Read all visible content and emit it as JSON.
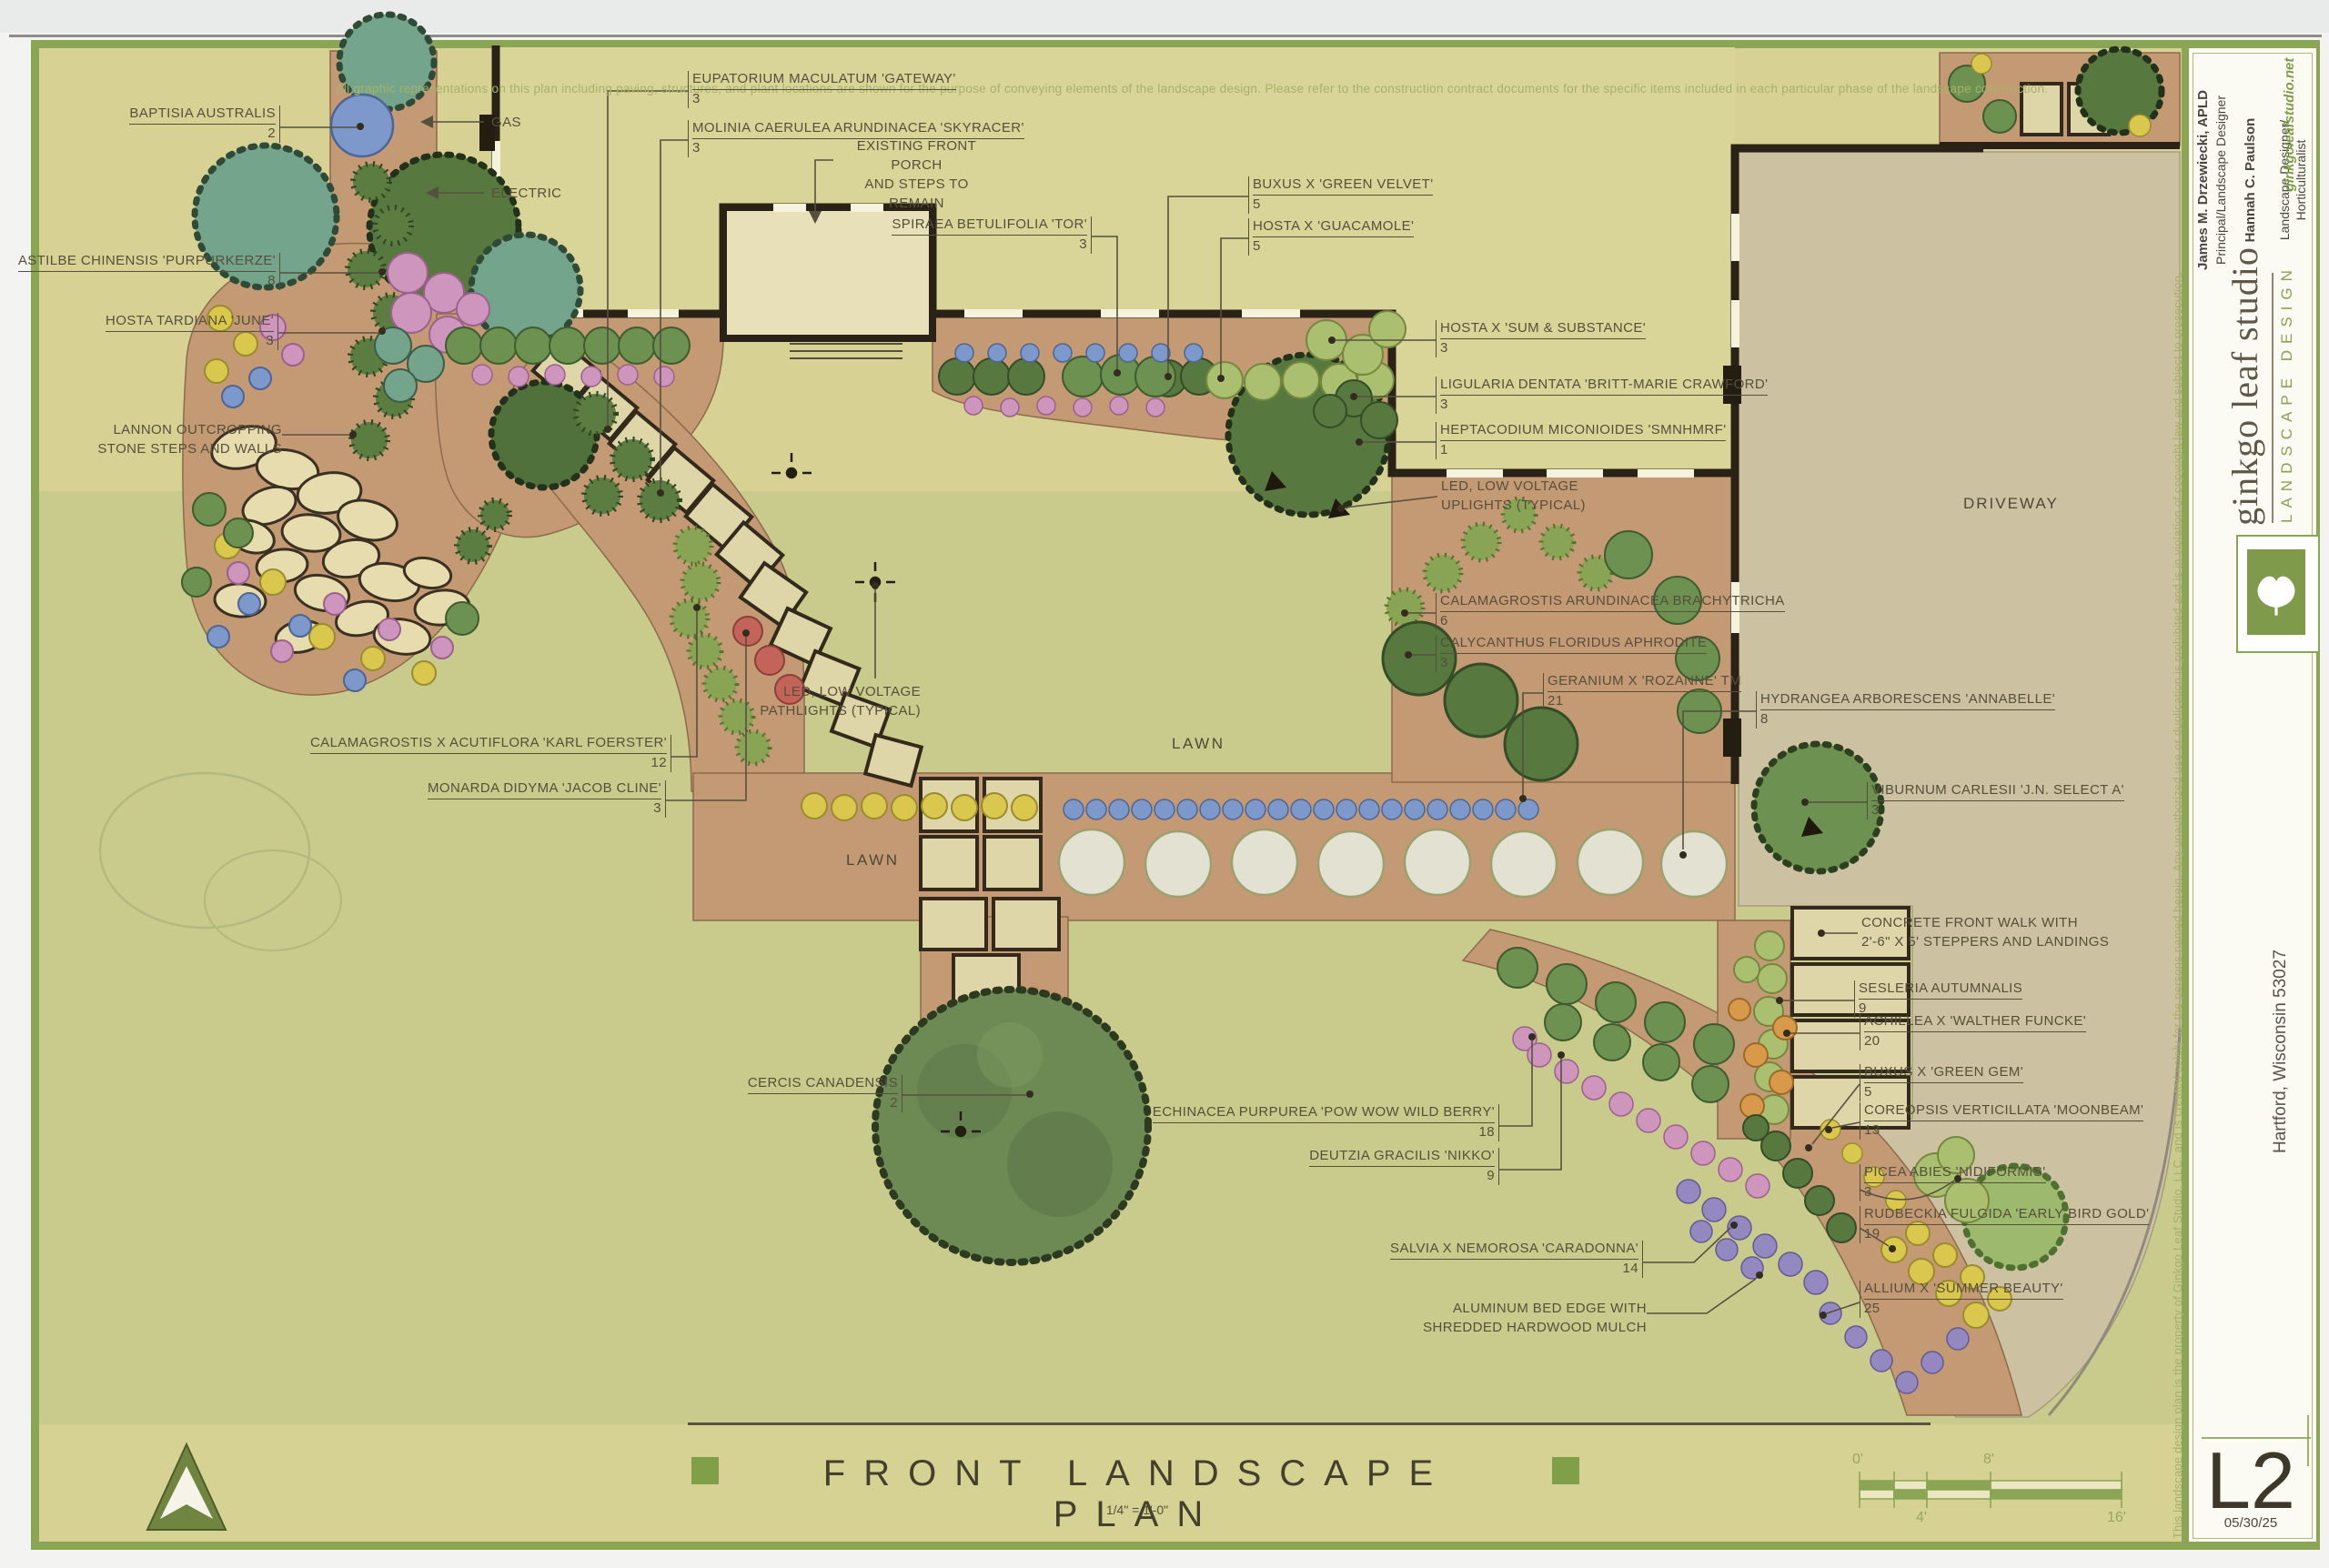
{
  "sheet": {
    "disclaimer": "All graphic representations on this plan including paving, structures, and plant locations are shown for the purpose of conveying elements of the landscape design.  Please refer to the construction contract documents for the specific items included in each particular phase of the landscape construction.",
    "copyright": "This landscape design plan is the property of Ginkgo Leaf Studio, LLC, and is created solely for the persons named herein.  Any unauthorized use or duplication is prohibited and is in violation of copyright law and subject to prosecution.",
    "title": "FRONT LANDSCAPE PLAN",
    "scale_note": "1/4\" = 1'-0\"",
    "north_label": "north"
  },
  "title_block": {
    "studio_name": "ginkgo leaf studio",
    "studio_tagline": "LANDSCAPE DESIGN",
    "credits": [
      {
        "name": "James M. Drzewiecki, APLD",
        "role": "Principal/Landscape Designer"
      },
      {
        "name": "Hannah C. Paulson",
        "role": "Landscape Designer/\nHorticulturalist"
      }
    ],
    "website": "ginkgoleafstudio.net",
    "project_location": "Hartford, Wisconsin 53027",
    "sheet_number": "L2",
    "date": "05/30/25"
  },
  "scale_bar": {
    "d0": "0'",
    "d4": "4'",
    "d8": "8'",
    "d16": "16'"
  },
  "areas": {
    "lawn": "LAWN",
    "driveway": "DRIVEWAY"
  },
  "plants": [
    {
      "label": "BAPTISIA AUSTRALIS",
      "qty": "2"
    },
    {
      "label": "ASTILBE CHINENSIS 'PURPURKERZE'",
      "qty": "8"
    },
    {
      "label": "HOSTA TARDIANA 'JUNE'",
      "qty": "3"
    },
    {
      "label": "CALAMAGROSTIS X ACUTIFLORA 'KARL FOERSTER'",
      "qty": "12"
    },
    {
      "label": "MONARDA DIDYMA 'JACOB CLINE'",
      "qty": "3"
    },
    {
      "label": "CERCIS CANADENSIS",
      "qty": "2"
    },
    {
      "label": "ECHINACEA PURPUREA 'POW WOW WILD BERRY'",
      "qty": "18"
    },
    {
      "label": "DEUTZIA GRACILIS 'NIKKO'",
      "qty": "9"
    },
    {
      "label": "SALVIA X NEMOROSA 'CARADONNA'",
      "qty": "14"
    },
    {
      "label": "SPIRAEA BETULIFOLIA 'TOR'",
      "qty": "3"
    },
    {
      "label": "EUPATORIUM MACULATUM 'GATEWAY'",
      "qty": "3"
    },
    {
      "label": "MOLINIA CAERULEA ARUNDINACEA 'SKYRACER'",
      "qty": "3"
    },
    {
      "label": "BUXUS X 'GREEN VELVET'",
      "qty": "5"
    },
    {
      "label": "HOSTA X 'GUACAMOLE'",
      "qty": "5"
    },
    {
      "label": "HOSTA X 'SUM & SUBSTANCE'",
      "qty": "3"
    },
    {
      "label": "LIGULARIA DENTATA 'BRITT-MARIE CRAWFORD'",
      "qty": "3"
    },
    {
      "label": "HEPTACODIUM MICONIOIDES 'SMNHMRF'",
      "qty": "1"
    },
    {
      "label": "CALAMAGROSTIS ARUNDINACEA BRACHYTRICHA",
      "qty": "6"
    },
    {
      "label": "CALYCANTHUS FLORIDUS APHRODITE",
      "qty": "3"
    },
    {
      "label": "GERANIUM X 'ROZANNE' TM",
      "qty": "21"
    },
    {
      "label": "HYDRANGEA ARBORESCENS 'ANNABELLE'",
      "qty": "8"
    },
    {
      "label": "VIBURNUM CARLESII 'J.N. SELECT A'",
      "qty": "3"
    },
    {
      "label": "SESLERIA AUTUMNALIS",
      "qty": "9"
    },
    {
      "label": "ACHILLEA X 'WALTHER FUNCKE'",
      "qty": "20"
    },
    {
      "label": "BUXUS X 'GREEN GEM'",
      "qty": "5"
    },
    {
      "label": "COREOPSIS VERTICILLATA 'MOONBEAM'",
      "qty": "13"
    },
    {
      "label": "PICEA ABIES 'NIDIFORMIS'",
      "qty": "3"
    },
    {
      "label": "RUDBECKIA FULGIDA 'EARLY BIRD GOLD'",
      "qty": "19"
    },
    {
      "label": "ALLIUM X 'SUMMER BEAUTY'",
      "qty": "25"
    }
  ],
  "notes": [
    {
      "text": "LANNON OUTCROPPING\nSTONE STEPS AND WALLS"
    },
    {
      "text": "GAS"
    },
    {
      "text": "ELECTRIC"
    },
    {
      "text": "EXISTING FRONT PORCH\nAND STEPS TO REMAIN"
    },
    {
      "text": "LED, LOW VOLTAGE\nPATHLIGHTS (TYPICAL)"
    },
    {
      "text": "LED, LOW VOLTAGE\nUPLIGHTS (TYPICAL)"
    },
    {
      "text": "CONCRETE FRONT WALK WITH\n2'-6\" X 5' STEPPERS AND LANDINGS"
    },
    {
      "text": "ALUMINUM BED EDGE WITH\nSHREDDED HARDWOOD MULCH"
    }
  ],
  "colors": {
    "paper": "#d7d294",
    "lawn": "#c8cb8c",
    "mulch": "#c49a74",
    "driveway": "#ccc1a1",
    "frame_green": "#8aa553",
    "ink": "#564f3b",
    "wall": "#2a2217",
    "accent_green": "#7fa049"
  }
}
